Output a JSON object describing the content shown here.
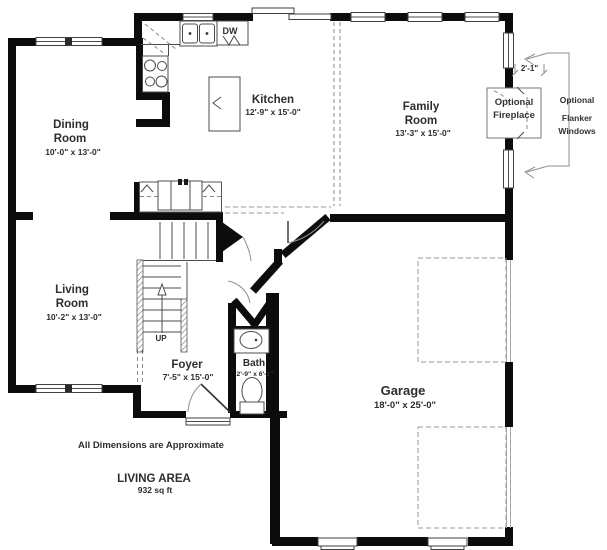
{
  "plan": {
    "rooms": {
      "dining": {
        "name1": "Dining",
        "name2": "Room",
        "dims": "10'-0\" x 13'-0\""
      },
      "kitchen": {
        "name": "Kitchen",
        "dims": "12'-9\" x 15'-0\""
      },
      "family": {
        "name1": "Family",
        "name2": "Room",
        "dims": "13'-3\" x 15'-0\""
      },
      "living": {
        "name1": "Living",
        "name2": "Room",
        "dims": "10'-2\" x 13'-0\""
      },
      "foyer": {
        "name": "Foyer",
        "dims": "7'-5\" x 15'-0\""
      },
      "bath": {
        "name": "Bath",
        "dims": "2'-9\" x 6'-1\""
      },
      "garage": {
        "name": "Garage",
        "dims": "18'-0\" x 25'-0\""
      }
    },
    "labels": {
      "up": "UP",
      "dishwasher": "DW",
      "fireplace_line1": "Optional",
      "fireplace_line2": "Fireplace",
      "flanker_line1": "Optional",
      "flanker_line2": "Flanker",
      "flanker_line3": "Windows",
      "dim_fireplace_offset": "2'-1\""
    },
    "footer": {
      "note": "All Dimensions are Approximate",
      "area_title": "LIVING AREA",
      "area_value": "932 sq ft"
    },
    "colors": {
      "wall": "#0c0c0c",
      "thin_line": "#4c4c4c",
      "dashed_line": "#9a9a9a",
      "text": "#2d2d2d"
    }
  }
}
